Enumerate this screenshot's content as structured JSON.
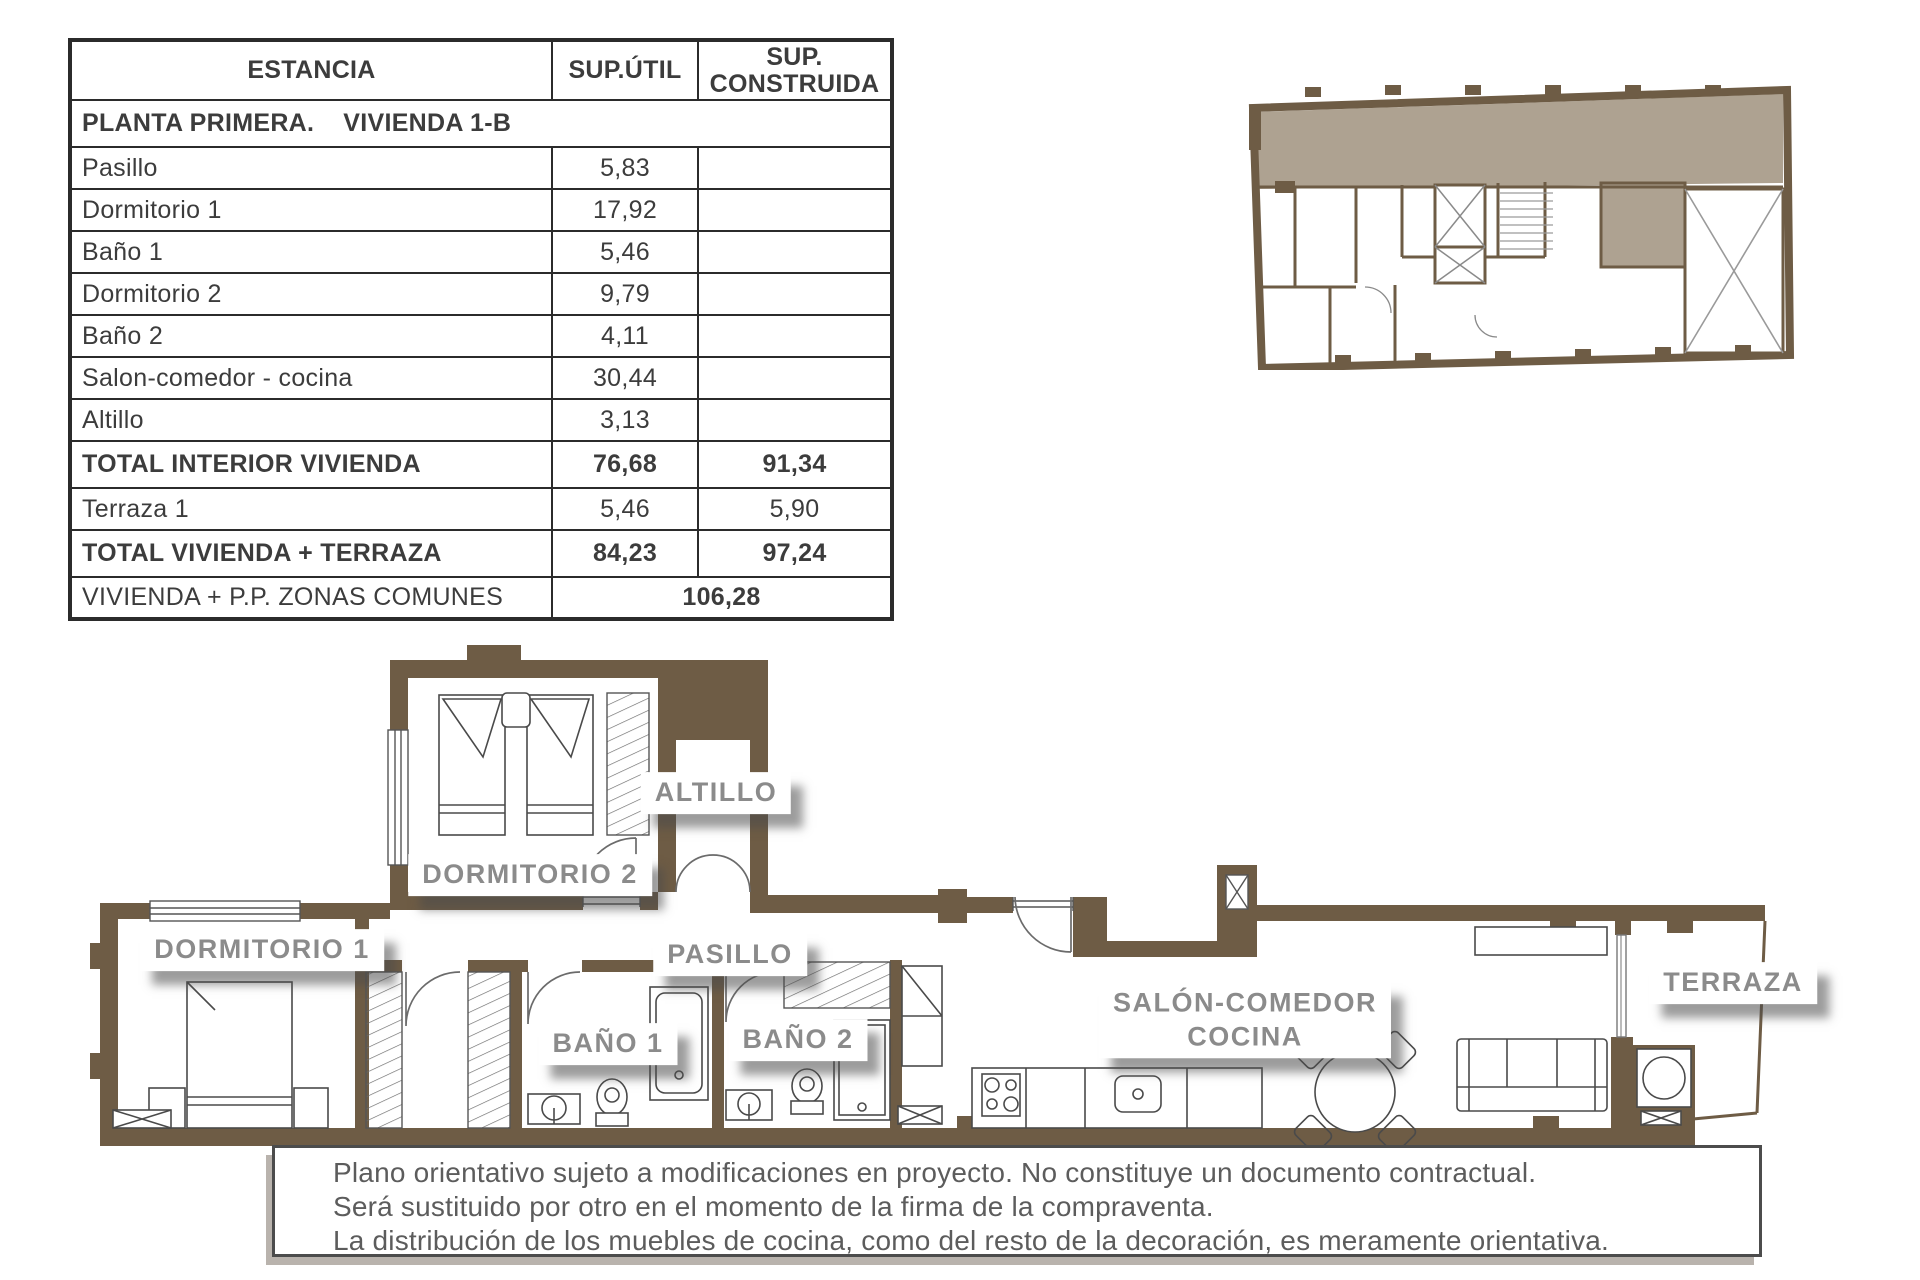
{
  "table": {
    "headers": {
      "estancia": "ESTANCIA",
      "sup_util": "SUP.ÚTIL",
      "sup_construida": "SUP. CONSTRUIDA"
    },
    "section_title": "PLANTA PRIMERA.    VIVIENDA 1-B",
    "rows": [
      {
        "label": "Pasillo",
        "util": "5,83",
        "construida": "",
        "bold": false
      },
      {
        "label": "Dormitorio 1",
        "util": "17,92",
        "construida": "",
        "bold": false
      },
      {
        "label": "Baño 1",
        "util": "5,46",
        "construida": "",
        "bold": false
      },
      {
        "label": "Dormitorio 2",
        "util": "9,79",
        "construida": "",
        "bold": false
      },
      {
        "label": "Baño 2",
        "util": "4,11",
        "construida": "",
        "bold": false
      },
      {
        "label": "Salon-comedor - cocina",
        "util": "30,44",
        "construida": "",
        "bold": false
      },
      {
        "label": "Altillo",
        "util": "3,13",
        "construida": "",
        "bold": false
      },
      {
        "label": "TOTAL INTERIOR VIVIENDA",
        "util": "76,68",
        "construida": "91,34",
        "bold": true
      },
      {
        "label": "Terraza 1",
        "util": "5,46",
        "construida": "5,90",
        "bold": false
      },
      {
        "label": "TOTAL VIVIENDA + TERRAZA",
        "util": "84,23",
        "construida": "97,24",
        "bold": true
      }
    ],
    "footer_row": {
      "label": "VIVIENDA + P.P. ZONAS COMUNES",
      "value": "106,28"
    }
  },
  "plan": {
    "labels": {
      "altillo": "ALTILLO",
      "dormitorio2": "DORMITORIO 2",
      "dormitorio1": "DORMITORIO 1",
      "pasillo": "PASILLO",
      "bano1": "BAÑO 1",
      "bano2": "BAÑO 2",
      "salon_line1": "SALÓN-COMEDOR",
      "salon_line2": "COCINA",
      "terraza": "TERRAZA"
    }
  },
  "disclaimer": {
    "lines": [
      "Plano orientativo sujeto a modificaciones en proyecto. No constituye un documento contractual.",
      "Será sustituido por otro en el momento de la firma de la compraventa.",
      "La distribución de los muebles de cocina, como del resto de la decoración, es meramente orientativa."
    ]
  },
  "colors": {
    "wall": "#6e5c45",
    "unit_shade": "#aea291",
    "label_text": "#8b8b8b",
    "table_border": "#2b2b2b",
    "disclaimer_text": "#5c5c5c"
  }
}
